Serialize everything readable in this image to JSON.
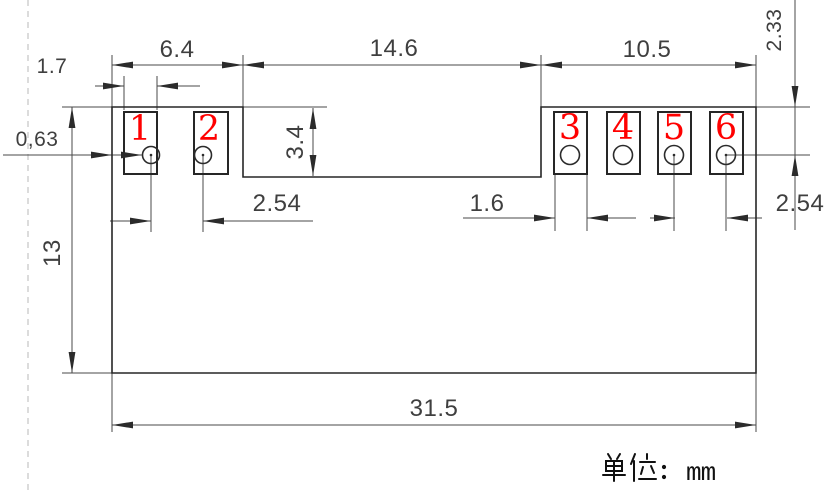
{
  "drawing": {
    "unit_note": {
      "full_text": "单位：mm",
      "cjk_label": "单位",
      "colon": "：",
      "unit": "mm"
    },
    "pad_numbers": [
      "1",
      "2",
      "3",
      "4",
      "5",
      "6"
    ],
    "dims": {
      "left_section_width": "6.4",
      "middle_section_width": "14.6",
      "right_section_width": "10.5",
      "left_pad_width": "1.7",
      "edge_to_hole": "0,63",
      "notch_depth": "3.4",
      "body_height": "13",
      "left_pad_pitch": "2.54",
      "right_pad_width": "1.6",
      "right_pad_pitch": "2.54",
      "top_to_hole_center": "2.33",
      "body_width": "31.5"
    },
    "colors": {
      "line": "#4a4a4a",
      "outline": "#262626",
      "pad_number_red": "#ff0000",
      "dashed_gray": "#b8b8b8"
    }
  }
}
